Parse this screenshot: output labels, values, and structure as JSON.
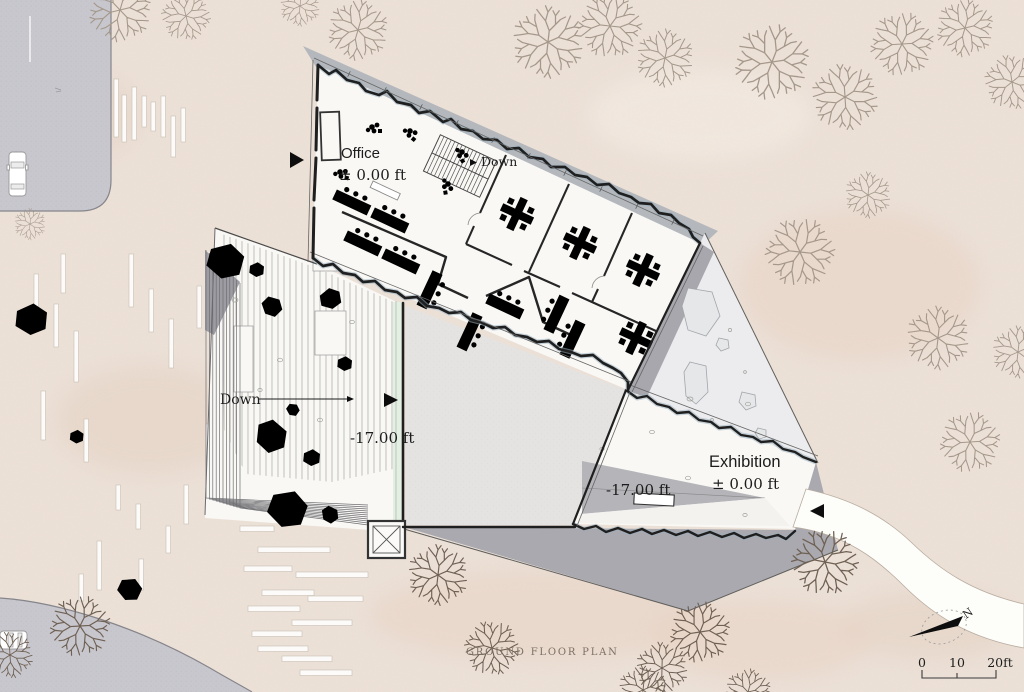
{
  "title": "GROUND FLOOR PLAN",
  "annotations": {
    "office_name": "Office",
    "office_level": "± 0.00 ft",
    "office_down": "Down",
    "plaza_down": "Down",
    "plaza_level": "-17.00 ft",
    "exhibition_name": "Exhibition",
    "exhibition_level": "± 0.00 ft",
    "exhibition_ramp_level": "-17.00 ft"
  },
  "scale_bar": {
    "tick_0": "0",
    "tick_10": "10",
    "tick_20": "20ft"
  },
  "compass": {
    "north_label": "N"
  },
  "colors": {
    "terrain": "#ece1d8",
    "road": "#c7c7cd",
    "excavation": "#a9a9af",
    "floor": "#f9f8f5",
    "courtyard": "#e4e3e1",
    "rock_blue": "#cfe2f2",
    "tree_light": "#a5988b",
    "tree_dark": "#6f6054",
    "wall": "#1f1f1f",
    "path_white": "#fdfdfa"
  }
}
